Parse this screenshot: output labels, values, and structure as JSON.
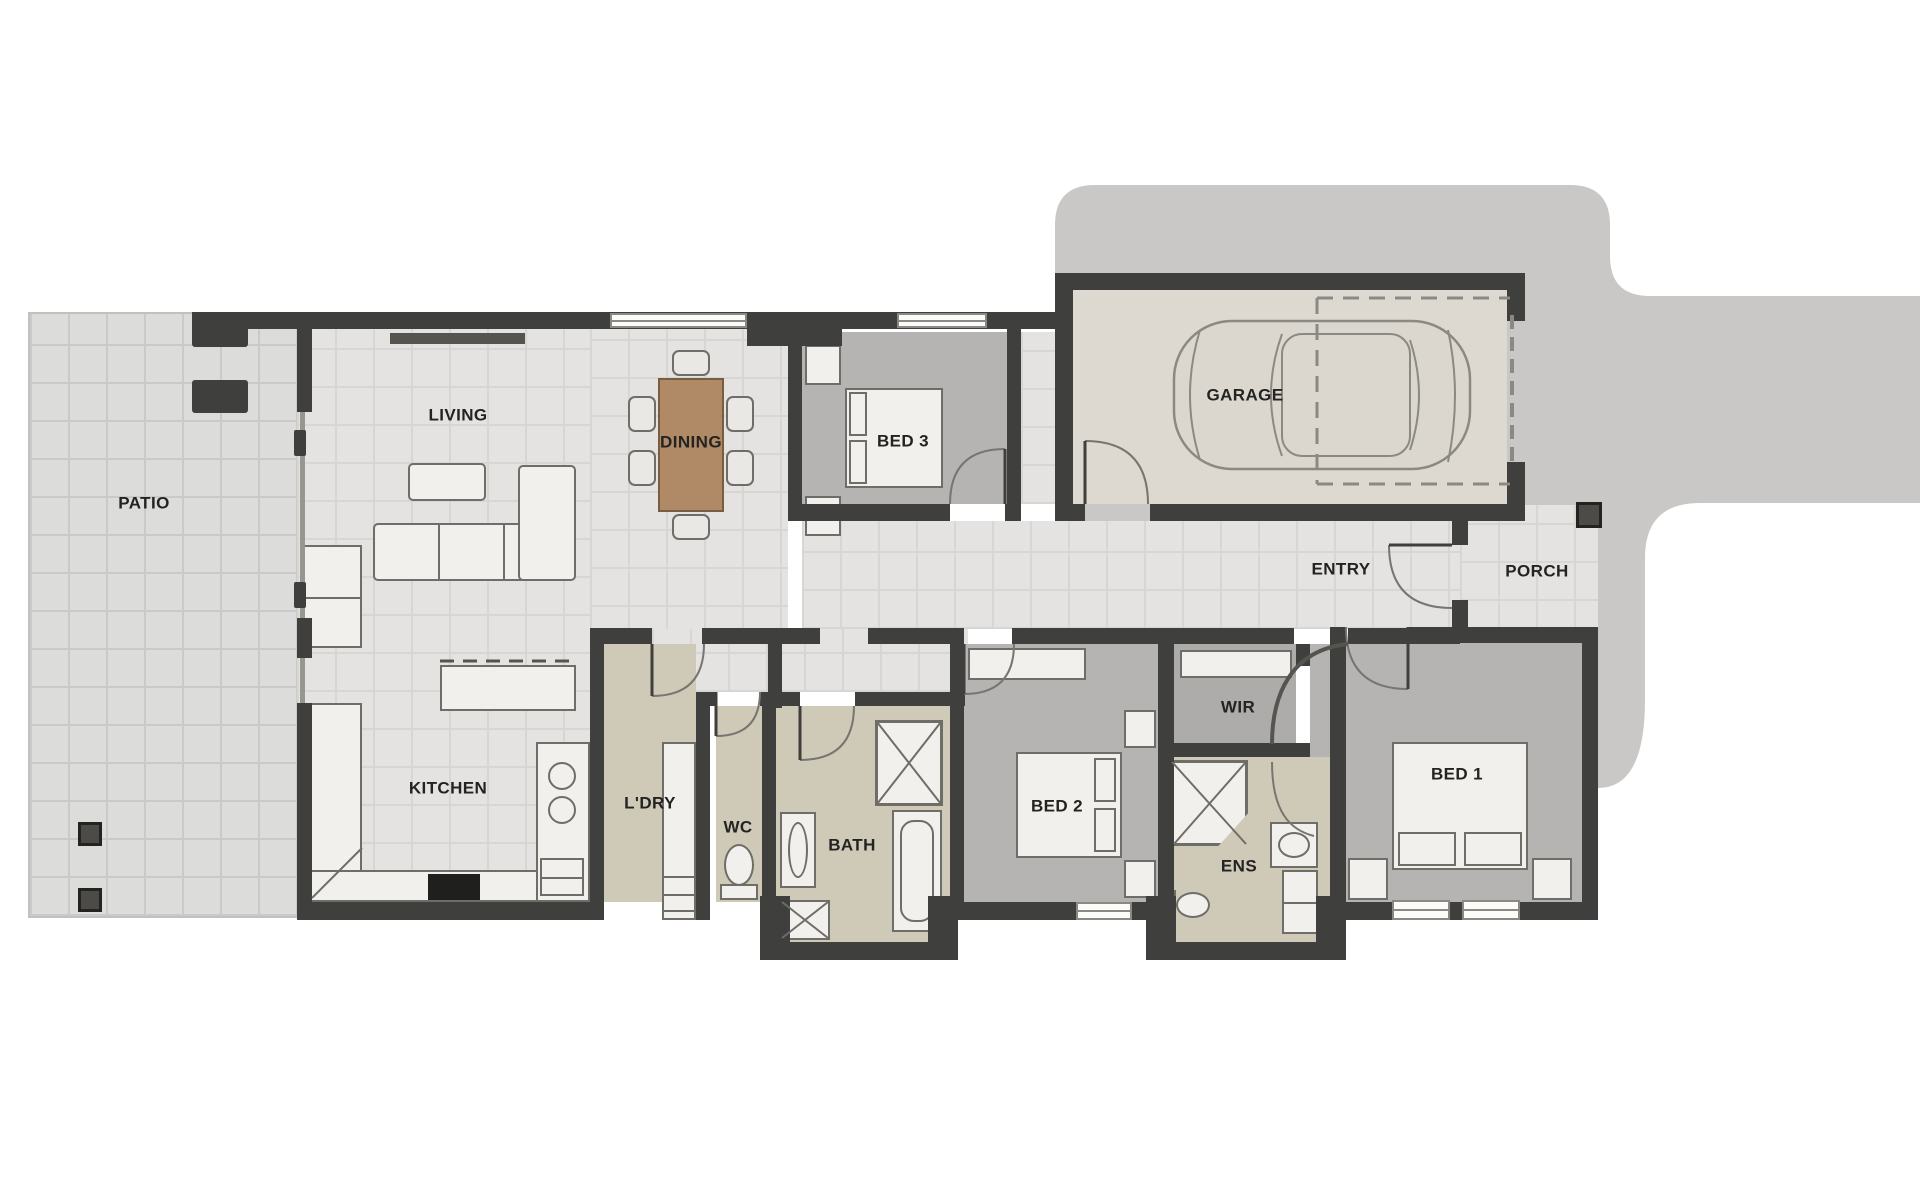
{
  "title": "House floor plan",
  "canvas": {
    "width": 1920,
    "height": 1200
  },
  "colors": {
    "wall": "#3f3f3d",
    "wall2": "#55544f",
    "patio": "#dcdcda",
    "patioline": "#cbcac8",
    "indoor": "#e4e3e1",
    "indoorline": "#d7d6d4",
    "bed": "#b5b4b2",
    "wir": "#adacaa",
    "wet": "#cfc9b8",
    "garage": "#ddd9d0",
    "drive": "#c9c8c6",
    "furn": "#f1f0ec",
    "furnstroke": "#6e6d68",
    "table": "#b08a66",
    "label": "#232321"
  },
  "rooms": [
    {
      "id": "patio",
      "label": "PATIO"
    },
    {
      "id": "living",
      "label": "LIVING"
    },
    {
      "id": "dining",
      "label": "DINING"
    },
    {
      "id": "bed3",
      "label": "BED 3"
    },
    {
      "id": "garage",
      "label": "GARAGE"
    },
    {
      "id": "entry",
      "label": "ENTRY"
    },
    {
      "id": "porch",
      "label": "PORCH"
    },
    {
      "id": "kitchen",
      "label": "KITCHEN"
    },
    {
      "id": "laundry",
      "label": "L'DRY"
    },
    {
      "id": "wc",
      "label": "WC"
    },
    {
      "id": "bath",
      "label": "BATH"
    },
    {
      "id": "bed2",
      "label": "BED 2"
    },
    {
      "id": "wir",
      "label": "WIR"
    },
    {
      "id": "ens",
      "label": "ENS"
    },
    {
      "id": "bed1",
      "label": "BED 1"
    }
  ],
  "fixtures": [
    "dining-table",
    "dining-chair",
    "sofa",
    "coffee-table",
    "kitchen-island",
    "kitchen-bench",
    "fridge",
    "stove",
    "sink",
    "dishwasher",
    "laundry-bench",
    "toilet",
    "shower",
    "bathtub",
    "vanity",
    "bed",
    "nightstand",
    "pillow",
    "robe-shelf",
    "car",
    "window",
    "door",
    "patio-post",
    "porch-post"
  ]
}
